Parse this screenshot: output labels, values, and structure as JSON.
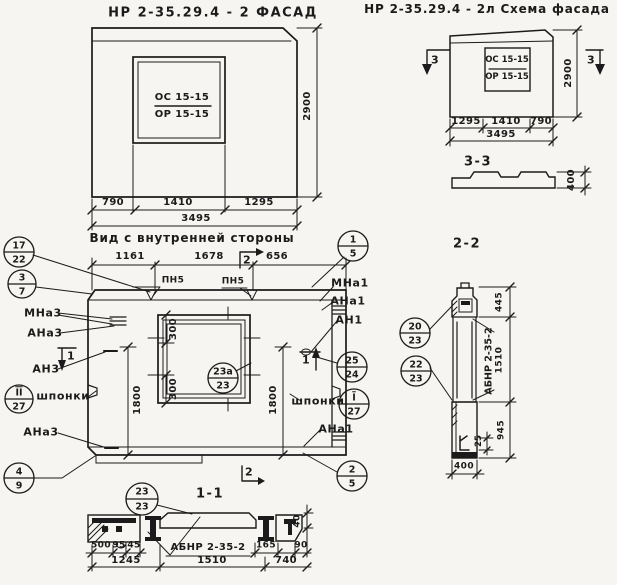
{
  "colors": {
    "paper": "#f6f5f1",
    "ink": "#1b1b1b"
  },
  "facade": {
    "title": "НР 2-35.29.4 - 2 ФАСАД",
    "opening_top": "ОС 15-15",
    "opening_bottom": "ОР 15-15",
    "dim_left": "790",
    "dim_mid": "1410",
    "dim_right": "1295",
    "dim_total": "3495",
    "dim_height": "2900"
  },
  "scheme": {
    "title": "НР 2-35.29.4 - 2л Схема фасада",
    "opening_top": "ОС 15-15",
    "opening_bottom": "ОР 15-15",
    "marker_left": "3",
    "marker_right": "3",
    "dim_left": "1295",
    "dim_mid": "1410",
    "dim_right": "790",
    "dim_total": "3495",
    "dim_height": "2900",
    "section_label": "3-3",
    "section_height": "400"
  },
  "inner": {
    "title": "Вид с внутренней стороны",
    "dim_top_left": "1161",
    "dim_top_mid": "1678",
    "dim_top_right": "656",
    "weld_left": "ПН5",
    "weld_right": "ПН5",
    "marker_top": "2",
    "marker_bottom": "2",
    "marker_left": "1",
    "marker_right": "1",
    "dim_win_top": "300",
    "dim_win_bottom": "300",
    "dim_height_left": "1800",
    "dim_height_right": "1800",
    "labels": {
      "mna3": "МНа3",
      "ana3": "АНа3",
      "an3": "АН3",
      "keys_left": "шпонки",
      "ana3b": "АНа3",
      "mna1": "МНа1",
      "ana1": "АНа1",
      "an1": "АН1",
      "keys_right": "шпонки",
      "ana1b": "АНа1"
    },
    "bubbles": {
      "b17": {
        "top": "17",
        "bottom": "22"
      },
      "b3": {
        "top": "3",
        "bottom": "7"
      },
      "b27l": {
        "top": "II",
        "bottom": "27"
      },
      "b4": {
        "top": "4",
        "bottom": "9"
      },
      "b1": {
        "top": "1",
        "bottom": "5"
      },
      "b25": {
        "top": "25",
        "bottom": "24"
      },
      "b27r": {
        "top": "I",
        "bottom": "27"
      },
      "b2": {
        "top": "2",
        "bottom": "5"
      },
      "b23a": {
        "top": "23а",
        "bottom": "23"
      }
    }
  },
  "section11": {
    "label": "1-1",
    "beam_mark": "АБНР 2-35-2",
    "bubble": {
      "top": "23",
      "bottom": "23"
    },
    "dim_500": "500",
    "dim_95": "95",
    "dim_45": "45",
    "dim_165": "165",
    "dim_90": "90",
    "dim_40": "40",
    "dim_1245": "1245",
    "dim_1510": "1510",
    "dim_740": "740"
  },
  "section22": {
    "label": "2-2",
    "beam_mark": "АБНР 2-35-2",
    "bubbles": {
      "b20": {
        "top": "20",
        "bottom": "23"
      },
      "b22": {
        "top": "22",
        "bottom": "23"
      }
    },
    "dim_445": "445",
    "dim_1510": "1510",
    "dim_945": "945",
    "dim_25": "25",
    "dim_400": "400"
  }
}
